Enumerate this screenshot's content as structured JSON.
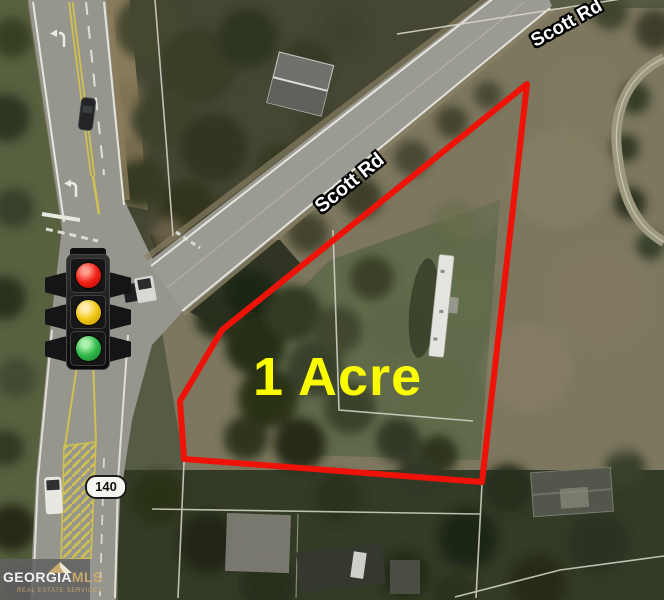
{
  "meta": {
    "type": "real-estate-aerial-listing-map",
    "width_px": 664,
    "height_px": 600
  },
  "parcel": {
    "acreage_label": "1 Acre",
    "outline_color": "#ee1208",
    "acreage_text_color": "#fcfc00"
  },
  "roads": {
    "scott_rd_label_top": "Scott Rd",
    "scott_rd_label_mid": "Scott Rd",
    "route_shield": "140"
  },
  "traffic_light": {
    "icon": "traffic-light",
    "lights": [
      {
        "name": "red",
        "color": "#f32015"
      },
      {
        "name": "yellow",
        "color": "#f2c713"
      },
      {
        "name": "green",
        "color": "#30b94a"
      }
    ]
  },
  "watermark": {
    "brand_primary": "GEORGIA",
    "brand_accent": "MLS",
    "tagline": "REAL ESTATE SERVICES",
    "accent_color": "#c8a96e"
  }
}
